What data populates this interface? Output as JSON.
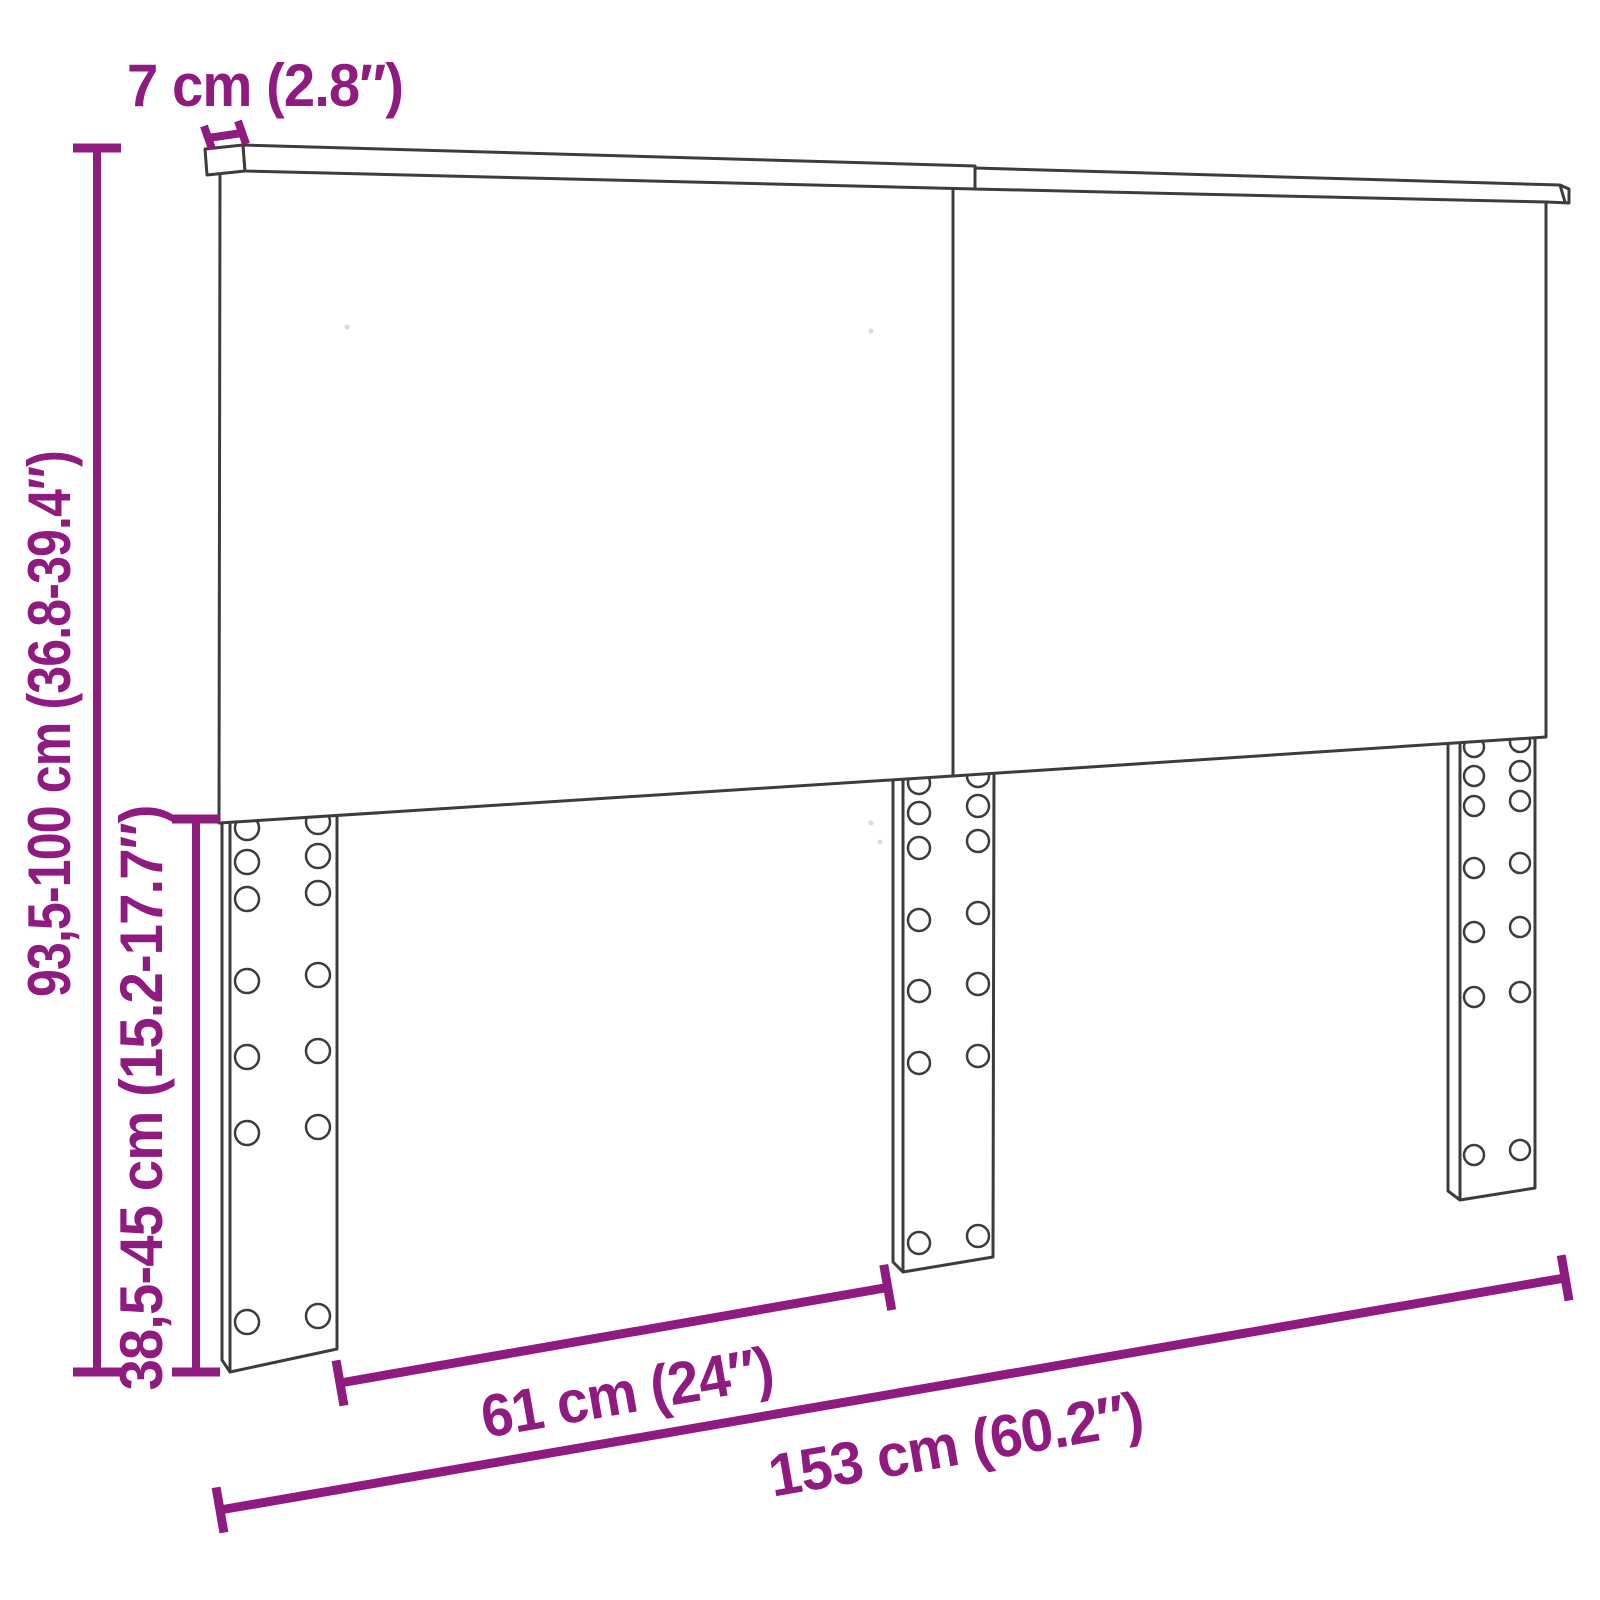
{
  "diagram": {
    "subject": "headboard-with-three-mounting-legs",
    "colors": {
      "accent": "#8f1b80",
      "outline": "#3c3c3c",
      "background": "#ffffff"
    },
    "labels": {
      "depth": "7 cm (2.8″)",
      "total_height": "93,5-100 cm (36.8-39.4″)",
      "leg_height": "38,5-45 cm (15.2-17.7″)",
      "leg_spacing": "61 cm (24″)",
      "total_width": "153 cm (60.2″)"
    }
  }
}
